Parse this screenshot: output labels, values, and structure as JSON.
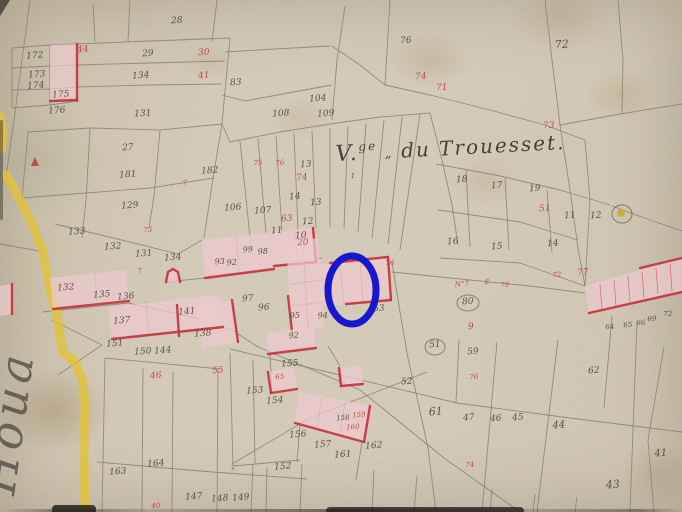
{
  "domain": "cadastral-map",
  "title": {
    "prefix": "V.",
    "sup": "ge",
    "sep": "„",
    "rest": "du Trouesset."
  },
  "left_margin_script": {
    "text": "Houa",
    "x": 14,
    "y": 496,
    "rotate": -82,
    "fs": 46
  },
  "colors": {
    "paper": "#d5cbb8",
    "ink": "#47423a",
    "red_ink": "#c03a33",
    "pink": "#eec9cf",
    "red_edge": "#c4313c",
    "road_yellow": "#e2c23a",
    "line": "#847d6c",
    "highlight_blue": "#1717d0"
  },
  "highlight_oval": {
    "cx": 352,
    "cy": 290,
    "rx": 24,
    "ry": 34,
    "stroke_width": 7
  },
  "map": {
    "roads": [
      {
        "name": "road-yellow-main",
        "width": 9,
        "pts": "6,175 20,200 33,226 43,252 48,281 56,312 61,340 63,352 74,361 82,378 85,402 84,452 85,512"
      },
      {
        "name": "road-yellow-top",
        "width": 7,
        "pts": "1,116 4,132 2,150"
      }
    ],
    "parcel_lines": [
      "30,0 14,120 6,176",
      "12,48 50,45 77,44 150,41 230,38",
      "12,68 50,66 77,65 150,63 225,61",
      "12,90 50,89 77,87 150,85 222,84",
      "12,48 12,108",
      "50,45 50,105",
      "95,42 93,4",
      "130,0 128,42",
      "217,0 212,42",
      "230,38 226,80 222,124",
      "12,108 50,105 77,101",
      "28,132 90,128 160,130 222,124",
      "225,52 275,49 330,46",
      "345,6 337,60 332,120",
      "222,95 245,101 272,96 304,90 332,85",
      "332,46 360,65 385,85",
      "390,0 385,85",
      "385,85 430,95 490,110 545,125 585,140",
      "545,0 552,60 560,125 570,190 578,248 585,286",
      "560,125 620,114 682,104",
      "618,0 623,60 622,113",
      "230,142 280,132 330,124 380,117 430,113",
      "222,124 230,142",
      "240,141 250,237",
      "258,138 266,234",
      "276,136 282,232",
      "294,134 298,230",
      "312,131 316,228",
      "330,128 330,227",
      "348,126 344,228",
      "366,124 358,232",
      "384,120 372,238",
      "402,117 388,244",
      "420,114 400,250",
      "430,113 442,160 452,205 458,245",
      "436,164 500,176 560,190 610,205",
      "466,170 470,247",
      "505,178 509,250",
      "547,190 552,253",
      "438,210 520,222 578,240",
      "440,258 520,263 585,286",
      "392,272 470,280 530,286 585,293",
      "42,312 128,303 196,318 232,330 258,347",
      "0,244 45,252",
      "55,224 130,242 178,254 202,240",
      "28,132 22,198",
      "90,129 86,200 82,238",
      "160,131 154,196 149,228",
      "222,124 214,172 204,238",
      "22,198 86,193 150,188 214,178",
      "392,262 400,312 408,358 418,402 428,448 436,512",
      "612,206 650,220 682,231",
      "585,140 590,200 587,250 585,286",
      "105,358 220,369",
      "105,358 102,512",
      "143,368 142,512",
      "173,372 172,512",
      "218,370 217,512",
      "97,462 200,471 307,479",
      "253,464 251,512",
      "267,467 266,512",
      "302,464 300,512",
      "52,320 102,345",
      "102,345 58,375",
      "230,353 233,466",
      "253,360 255,464",
      "233,466 300,460",
      "270,354 272,392",
      "300,424 297,462",
      "362,442 356,480",
      "230,349 340,375 457,403 570,418 682,432",
      "256,346 360,390 444,458 520,512",
      "232,464 310,418 427,372",
      "497,342 482,512",
      "558,340 537,512",
      "664,347 648,440 654,512",
      "612,316 604,408",
      "637,322 630,512",
      "459,340 456,402",
      "374,470 372,512",
      "417,476 414,512",
      "492,489 490,512",
      "535,494 533,512",
      "577,497 575,512",
      "322,397 317,428",
      "345,402 340,433",
      "236,236 239,273",
      "294,230 297,264",
      "95,273 97,304",
      "303,240 308,330",
      "288,262 322,258",
      "290,284 323,280",
      "292,306 324,302",
      "340,262 344,304",
      "360,260 363,302",
      "146,302 149,334",
      "328,346 340,366",
      "166,282 205,278"
    ],
    "buildings": [
      {
        "pts": "50,45 77,44 77,100 50,101",
        "edges": [
          "77,44 77,101",
          "50,101 77,100"
        ]
      },
      {
        "pts": "202,240 271,232 274,269 205,278",
        "edges": [
          "205,278 274,269"
        ]
      },
      {
        "pts": "271,232 313,228 316,262 274,266",
        "edges": [
          "274,266 316,262",
          "313,228 316,262"
        ]
      },
      {
        "pts": "286,242 318,238 324,328 292,332",
        "edges": [
          "288,296 292,332"
        ]
      },
      {
        "pts": "318,265 388,258 391,300 322,306",
        "edges": [
          "388,257 391,300",
          "346,304 391,300",
          "330,263 388,257"
        ]
      },
      {
        "pts": "196,306 232,300 238,342 202,348",
        "edges": [
          "232,300 238,342"
        ]
      },
      {
        "pts": "266,334 314,326 316,348 268,354",
        "edges": [
          "268,354 316,348"
        ]
      },
      {
        "pts": "50,278 126,270 129,301 53,309",
        "edges": [
          "53,309 129,301"
        ]
      },
      {
        "pts": "108,307 219,295 223,327 112,339",
        "edges": [
          "112,339 223,327",
          "177,305 179,336"
        ]
      },
      {
        "pts": "268,372 294,368 297,389 271,393",
        "edges": [
          "271,393 297,389",
          "268,372 271,393"
        ]
      },
      {
        "pts": "339,368 361,366 363,384 341,386",
        "edges": [
          "339,368 341,386",
          "341,386 363,384"
        ]
      },
      {
        "pts": "299,392 370,406 364,442 295,423",
        "edges": [
          "295,423 364,442",
          "370,406 364,442"
        ]
      },
      {
        "pts": "585,286 682,258 682,292 589,313",
        "edges": [
          "589,313 682,292",
          "640,268 682,258"
        ],
        "thin": [
          "600,284 602,310",
          "614,280 616,306",
          "628,276 630,302",
          "642,272 644,298",
          "656,268 658,294",
          "670,264 672,291"
        ]
      },
      {
        "pts": "0,286 12,284 12,314 0,316",
        "edges": [
          "12,284 12,314"
        ]
      },
      {
        "pts": "166,282 168,272 173,269 178,272 180,282",
        "edges": [
          "166,282 168,272 173,269 178,272 180,282"
        ]
      }
    ],
    "circles": [
      {
        "cx": 622,
        "cy": 214,
        "rx": 10,
        "ry": 9
      },
      {
        "cx": 468,
        "cy": 303,
        "rx": 11,
        "ry": 8
      },
      {
        "cx": 435,
        "cy": 347,
        "rx": 10,
        "ry": 8
      }
    ],
    "well_dot": {
      "cx": 621,
      "cy": 213,
      "r": 4
    },
    "red_mark": "31,166 39,166 35,157",
    "labels": [
      [
        "172",
        35,
        58,
        "k"
      ],
      [
        "44",
        83,
        52,
        "r"
      ],
      [
        "29",
        148,
        56,
        "k"
      ],
      [
        "30",
        204,
        55,
        "r"
      ],
      [
        "28",
        177,
        23,
        "k"
      ],
      [
        "134",
        141,
        78,
        "k"
      ],
      [
        "41",
        204,
        78,
        "r"
      ],
      [
        "83",
        236,
        85,
        "k"
      ],
      [
        "173",
        37,
        77,
        "k"
      ],
      [
        "174",
        36,
        88,
        "k"
      ],
      [
        "175",
        61,
        97,
        "k"
      ],
      [
        "176",
        57,
        113,
        "k"
      ],
      [
        "131",
        143,
        116,
        "k"
      ],
      [
        "27",
        128,
        150,
        "k"
      ],
      [
        "104",
        318,
        101,
        "k"
      ],
      [
        "108",
        281,
        116,
        "k"
      ],
      [
        "109",
        326,
        116,
        "k"
      ],
      [
        "76",
        406,
        43,
        "k"
      ],
      [
        "72",
        562,
        48,
        "k",
        11
      ],
      [
        "74",
        421,
        79,
        "r"
      ],
      [
        "71",
        442,
        90,
        "r"
      ],
      [
        "73",
        549,
        128,
        "r"
      ],
      [
        "1",
        353,
        178,
        "k",
        7
      ],
      [
        "18",
        462,
        182,
        "k"
      ],
      [
        "17",
        497,
        188,
        "k"
      ],
      [
        "19",
        535,
        191,
        "k"
      ],
      [
        "51",
        545,
        211,
        "r"
      ],
      [
        "11",
        570,
        218,
        "k"
      ],
      [
        "12",
        596,
        218,
        "k"
      ],
      [
        "16",
        453,
        244,
        "k"
      ],
      [
        "15",
        497,
        249,
        "k"
      ],
      [
        "14",
        553,
        246,
        "k"
      ],
      [
        "75",
        258,
        165,
        "r",
        7
      ],
      [
        "76",
        280,
        165,
        "r",
        7
      ],
      [
        "13",
        306,
        167,
        "k"
      ],
      [
        "74",
        302,
        180,
        "r"
      ],
      [
        "14",
        295,
        199,
        "k"
      ],
      [
        "13",
        316,
        205,
        "k"
      ],
      [
        "106",
        233,
        210,
        "k"
      ],
      [
        "107",
        263,
        213,
        "k"
      ],
      [
        "63",
        287,
        221,
        "r"
      ],
      [
        "12",
        308,
        224,
        "k"
      ],
      [
        "11",
        277,
        233,
        "k"
      ],
      [
        "10",
        301,
        238,
        "k"
      ],
      [
        "181",
        128,
        177,
        "k"
      ],
      [
        "182",
        210,
        173,
        "k"
      ],
      [
        "7",
        185,
        185,
        "r",
        7
      ],
      [
        "129",
        130,
        208,
        "k"
      ],
      [
        "133",
        77,
        234,
        "k"
      ],
      [
        "75",
        148,
        232,
        "r",
        7
      ],
      [
        "132",
        113,
        249,
        "k"
      ],
      [
        "131",
        144,
        256,
        "k"
      ],
      [
        "134",
        173,
        260,
        "k"
      ],
      [
        "7",
        140,
        273,
        "r",
        7
      ],
      [
        "20",
        303,
        245,
        "r"
      ],
      [
        "99",
        248,
        252,
        "k",
        8
      ],
      [
        "98",
        263,
        254,
        "k",
        8
      ],
      [
        "93",
        220,
        264,
        "k",
        8
      ],
      [
        "92",
        232,
        265,
        "k",
        8
      ],
      [
        "97",
        248,
        301,
        "k"
      ],
      [
        "96",
        264,
        310,
        "k"
      ],
      [
        "95",
        295,
        318,
        "k",
        8
      ],
      [
        "94",
        323,
        318,
        "k",
        8
      ],
      [
        "92",
        294,
        338,
        "k",
        8
      ],
      [
        "132",
        66,
        290,
        "k"
      ],
      [
        "135",
        102,
        297,
        "k"
      ],
      [
        "136",
        126,
        299,
        "k"
      ],
      [
        "137",
        122,
        323,
        "k"
      ],
      [
        "141",
        187,
        314,
        "k"
      ],
      [
        "138",
        203,
        336,
        "k"
      ],
      [
        "151",
        115,
        346,
        "k"
      ],
      [
        "150",
        143,
        354,
        "k"
      ],
      [
        "144",
        163,
        353,
        "k"
      ],
      [
        "46",
        156,
        378,
        "r"
      ],
      [
        "55",
        218,
        373,
        "r"
      ],
      [
        "76",
        390,
        265,
        "r",
        7
      ],
      [
        "53",
        379,
        311,
        "k"
      ],
      [
        "52",
        407,
        384,
        "k"
      ],
      [
        "51",
        435,
        347,
        "k"
      ],
      [
        "59",
        473,
        354,
        "k"
      ],
      [
        "61",
        436,
        415,
        "k",
        11
      ],
      [
        "80",
        468,
        304,
        "k"
      ],
      [
        "N°7",
        462,
        286,
        "r",
        7
      ],
      [
        "8",
        487,
        284,
        "r",
        7
      ],
      [
        "79",
        505,
        287,
        "r",
        7
      ],
      [
        "9",
        471,
        329,
        "r"
      ],
      [
        "72",
        557,
        277,
        "r",
        7
      ],
      [
        "77",
        583,
        275,
        "r"
      ],
      [
        "76",
        474,
        379,
        "r",
        7
      ],
      [
        "64",
        610,
        329,
        "k",
        7
      ],
      [
        "65",
        628,
        327,
        "k",
        7
      ],
      [
        "66",
        641,
        325,
        "k",
        7
      ],
      [
        "69",
        652,
        321,
        "k",
        7
      ],
      [
        "72",
        668,
        316,
        "k",
        7
      ],
      [
        "155",
        290,
        366,
        "k"
      ],
      [
        "65",
        280,
        379,
        "r",
        7
      ],
      [
        "153",
        255,
        393,
        "k"
      ],
      [
        "154",
        275,
        403,
        "k"
      ],
      [
        "156",
        298,
        437,
        "k"
      ],
      [
        "157",
        323,
        447,
        "k"
      ],
      [
        "161",
        343,
        457,
        "k"
      ],
      [
        "158",
        343,
        420,
        "k",
        7
      ],
      [
        "159",
        359,
        417,
        "r",
        7
      ],
      [
        "160",
        353,
        429,
        "r",
        7
      ],
      [
        "162",
        374,
        448,
        "k"
      ],
      [
        "152",
        283,
        469,
        "k"
      ],
      [
        "163",
        118,
        474,
        "k"
      ],
      [
        "164",
        156,
        466,
        "k"
      ],
      [
        "147",
        194,
        499,
        "k"
      ],
      [
        "148",
        220,
        501,
        "k"
      ],
      [
        "149",
        241,
        500,
        "k"
      ],
      [
        "40",
        156,
        508,
        "r",
        7
      ],
      [
        "x",
        233,
        470,
        "b",
        6
      ],
      [
        "74",
        470,
        467,
        "r",
        7
      ],
      [
        "43",
        613,
        488,
        "k",
        11
      ],
      [
        "62",
        594,
        373,
        "k"
      ],
      [
        "47",
        469,
        420,
        "k"
      ],
      [
        "46",
        496,
        421,
        "k"
      ],
      [
        "45",
        518,
        420,
        "k"
      ],
      [
        "44",
        559,
        428,
        "k",
        10
      ],
      [
        "41",
        661,
        456,
        "k",
        10
      ]
    ]
  }
}
